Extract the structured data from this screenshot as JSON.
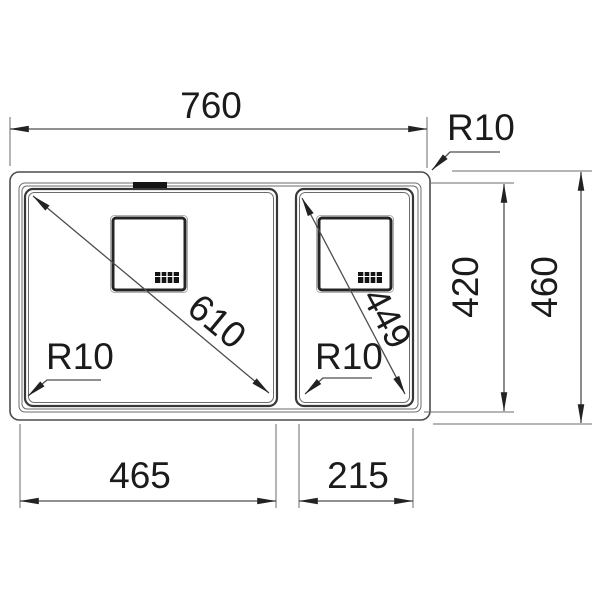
{
  "drawing": {
    "labels": {
      "overall_width": "760",
      "overall_depth": "460",
      "inner_depth": "420",
      "left_bowl_width": "465",
      "right_bowl_width": "215",
      "left_bowl_diagonal": "610",
      "right_bowl_diagonal": "449",
      "outer_corner_radius": "R10",
      "left_bowl_radius": "R10",
      "right_bowl_radius": "R10"
    },
    "colors": {
      "background": "#ffffff",
      "line": "#4d4d4d",
      "thin_line": "#6b6b6b",
      "dark_detail": "#242424",
      "text": "#1b1b1b"
    }
  }
}
